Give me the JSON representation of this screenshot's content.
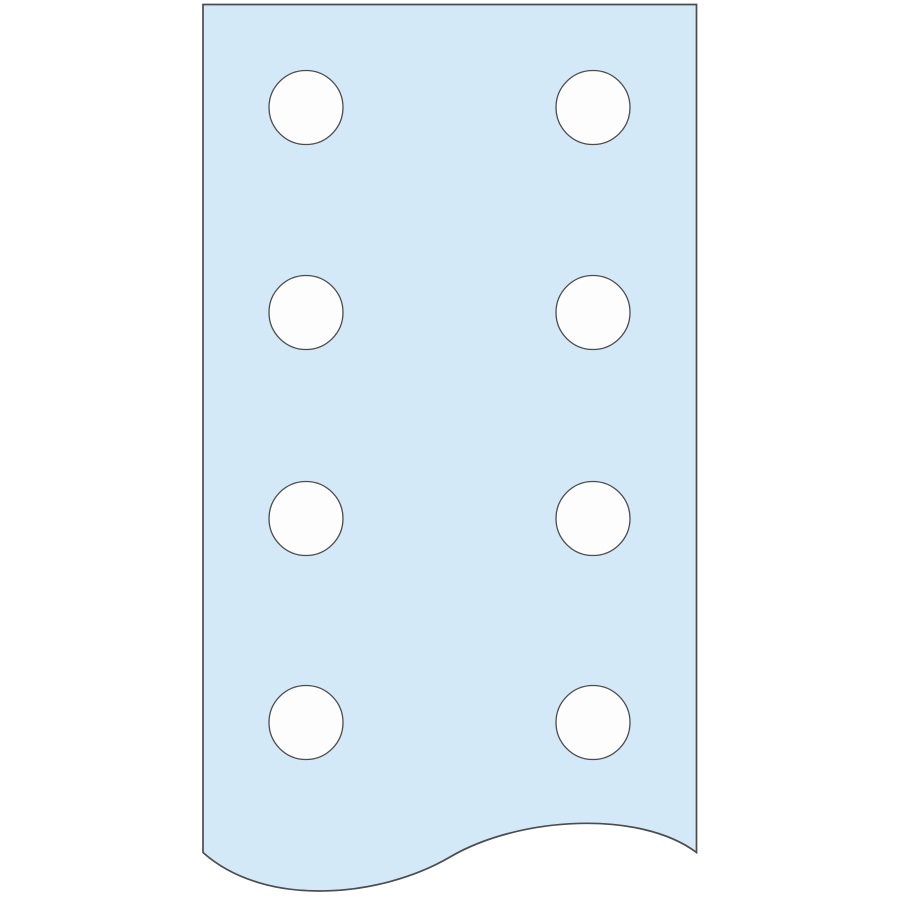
{
  "illustration": {
    "name": "perforated-flat-bar",
    "description": "Light blue flat busbar strip truncated at the bottom by a wavy break line, with two columns of four round punched holes",
    "canvas": {
      "width": 900,
      "height": 900,
      "background": "#ffffff"
    },
    "colors": {
      "plate_fill": "#D4E9F8",
      "outline": "#4C4C4C",
      "hole_fill": "#FDFDFE"
    },
    "plate": {
      "left": 203,
      "top": 4.5,
      "right": 696.5,
      "side_bottom_y": 852.5,
      "outline_width": 1.7,
      "wave": {
        "c1": [
          640,
          810
        ],
        "c2": [
          520,
          816
        ],
        "mid": [
          450,
          857
        ],
        "c3": [
          380,
          898
        ],
        "c4": [
          265,
          908
        ],
        "trough_y": 892,
        "crest_y": 823
      }
    },
    "holes": {
      "radius": 37,
      "stroke_width": 1.3,
      "columns_x": [
        306,
        593
      ],
      "rows_y": [
        107.5,
        312.5,
        518.5,
        722.5
      ]
    }
  }
}
